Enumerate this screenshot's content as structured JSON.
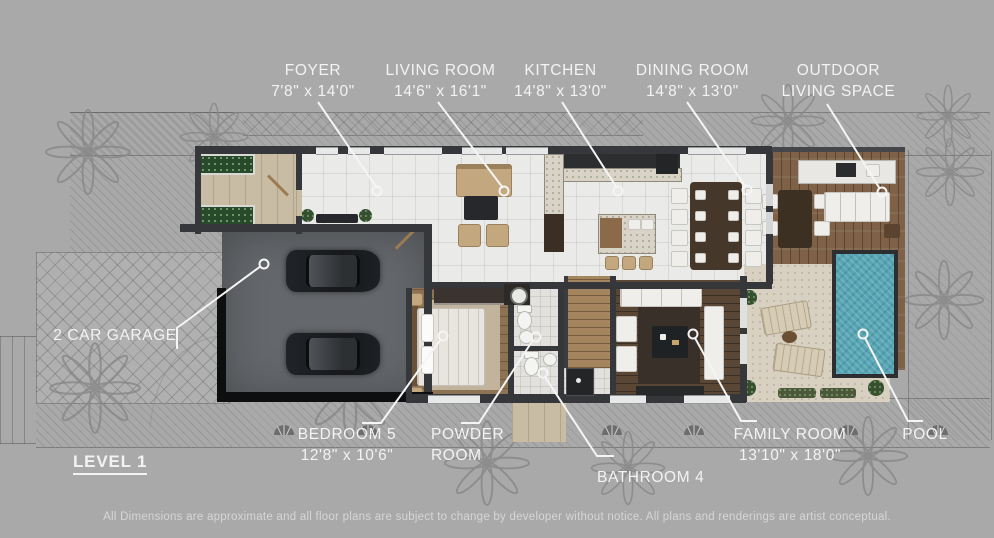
{
  "title": "Level 1 Floor Plan",
  "colors": {
    "background": "#a9a9a9",
    "label_text": "#f3f3f3",
    "leader_line": "#f5f5f5",
    "pool_water": "#57a5b4",
    "wall": "#35373a"
  },
  "rooms": {
    "foyer": {
      "label": "FOYER",
      "dims": "7'8\" x 14'0\""
    },
    "living_room": {
      "label": "LIVING ROOM",
      "dims": "14'6\" x 16'1\""
    },
    "kitchen": {
      "label": "KITCHEN",
      "dims": "14'8\" x 13'0\""
    },
    "dining_room": {
      "label": "DINING ROOM",
      "dims": "14'8\" x 13'0\""
    },
    "outdoor_living_space": {
      "label_line1": "OUTDOOR",
      "label_line2": "LIVING SPACE"
    },
    "garage": {
      "label": "2 CAR GARAGE"
    },
    "bedroom_5": {
      "label": "BEDROOM 5",
      "dims": "12'8\" x 10'6\""
    },
    "powder_room": {
      "label_line1": "POWDER",
      "label_line2": "ROOM"
    },
    "bathroom_4": {
      "label": "BATHROOM 4"
    },
    "family_room": {
      "label": "FAMILY ROOM",
      "dims": "13'10\" x 18'0\""
    },
    "pool": {
      "label": "POOL"
    }
  },
  "plan": {
    "level_label": "LEVEL 1"
  },
  "footer": {
    "disclaimer": "All Dimensions are approximate and all floor plans are subject to change by developer without notice. All plans and renderings are artist conceptual."
  }
}
